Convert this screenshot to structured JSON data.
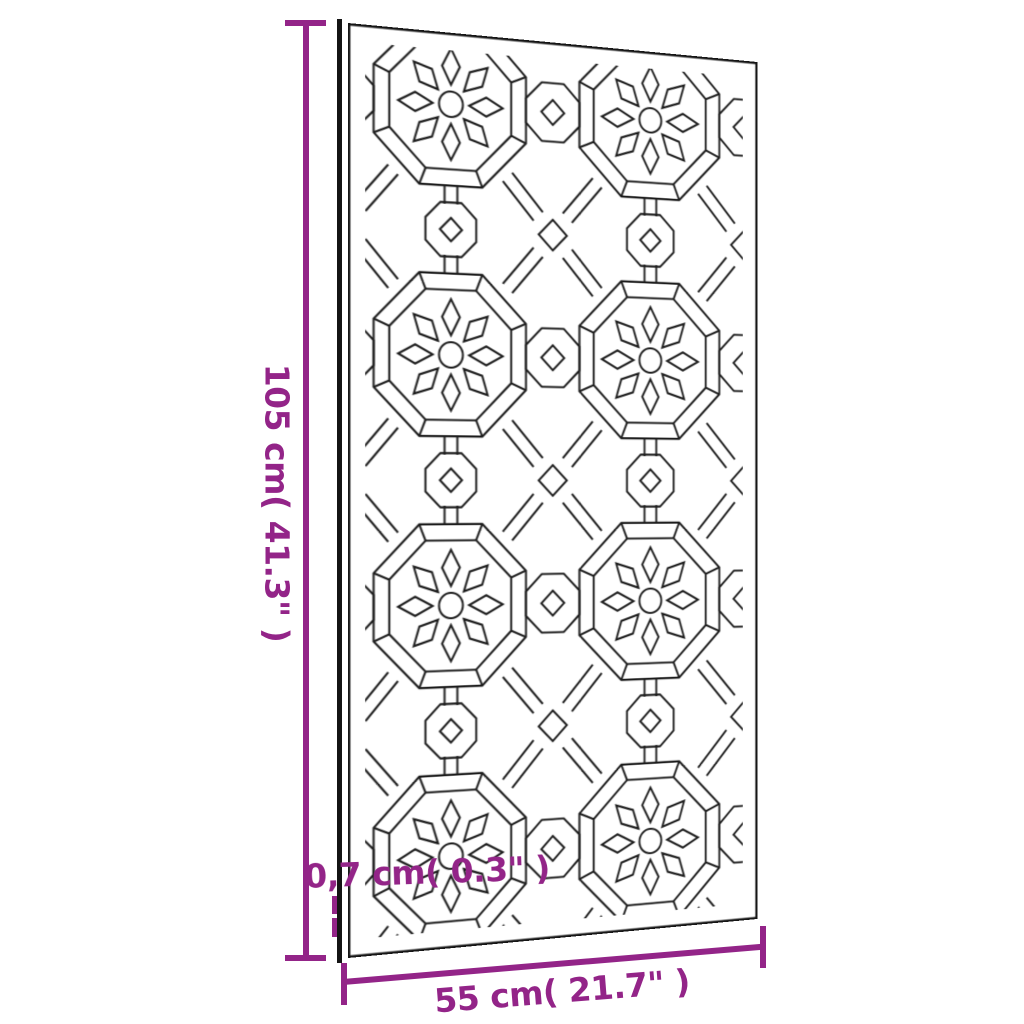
{
  "diagram": {
    "kind": "product-dimensions",
    "subject": "laser-cut moorish pattern garden wall panel",
    "background_color": "#ffffff",
    "accent_color": "#932488",
    "outline_color": "#1c1c1c",
    "height": {
      "label": "105 cm( 41.3\" )"
    },
    "width": {
      "label": "55 cm( 21.7\" )"
    },
    "thickness": {
      "label": "0,7 cm( 0.3\" )"
    }
  }
}
